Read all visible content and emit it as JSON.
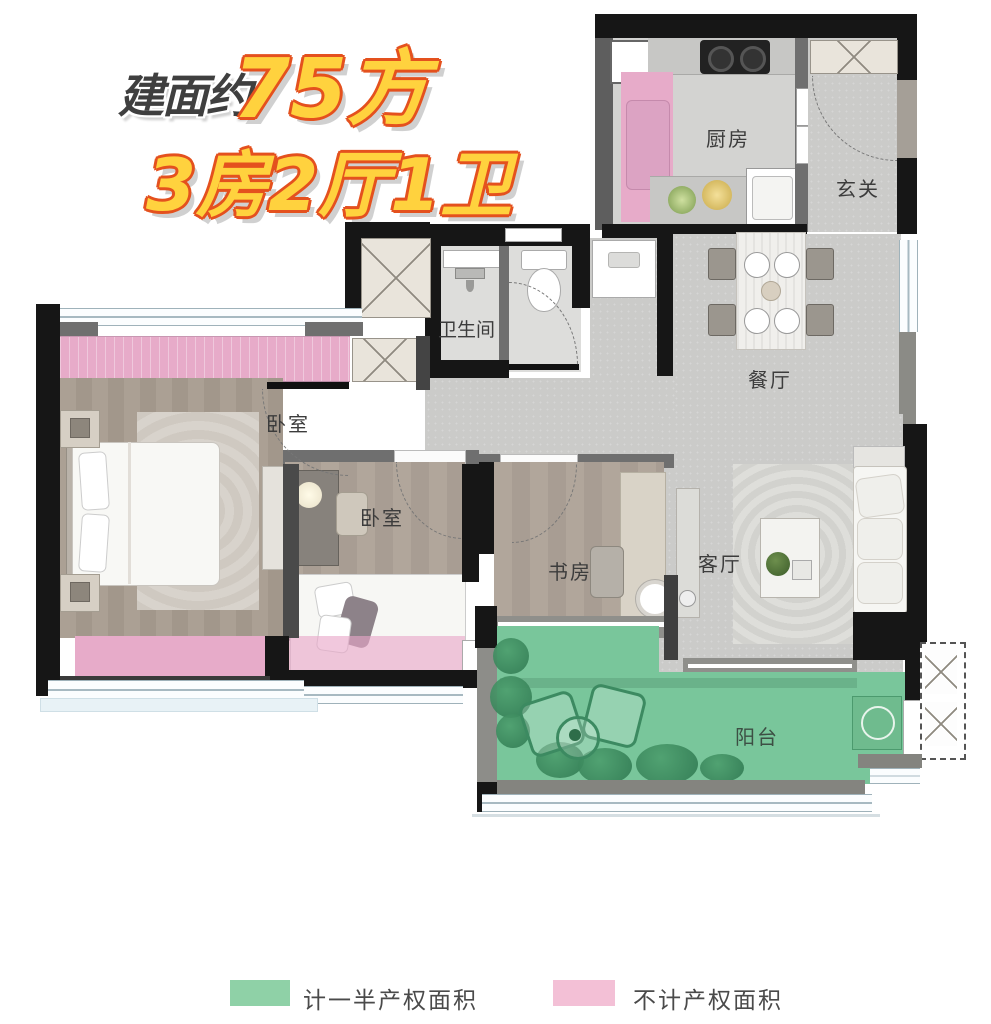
{
  "title": {
    "line1_prefix": "建面约",
    "line1_value": "75方",
    "line2": "3房2厅1卫"
  },
  "rooms": {
    "kitchen": {
      "label": "厨房"
    },
    "entry": {
      "label": "玄关"
    },
    "bathroom": {
      "label": "卫生间"
    },
    "dining": {
      "label": "餐厅"
    },
    "bedroom_master": {
      "label": "卧室"
    },
    "bedroom_second": {
      "label": "卧室"
    },
    "study": {
      "label": "书房"
    },
    "living": {
      "label": "客厅"
    },
    "balcony": {
      "label": "阳台"
    }
  },
  "legend": {
    "half_property": {
      "label": "计一半产权面积",
      "color": "#8fd1a7"
    },
    "no_property": {
      "label": "不计产权面积",
      "color": "#f3c0d6"
    }
  },
  "colors": {
    "accent_yellow": "#ffd23e",
    "accent_orange": "#e4511e",
    "wall_black": "#161616",
    "wall_gray": "#6f6f6f",
    "balcony_green": "#79c69b",
    "bay_window_pink": "#e7abc9"
  }
}
